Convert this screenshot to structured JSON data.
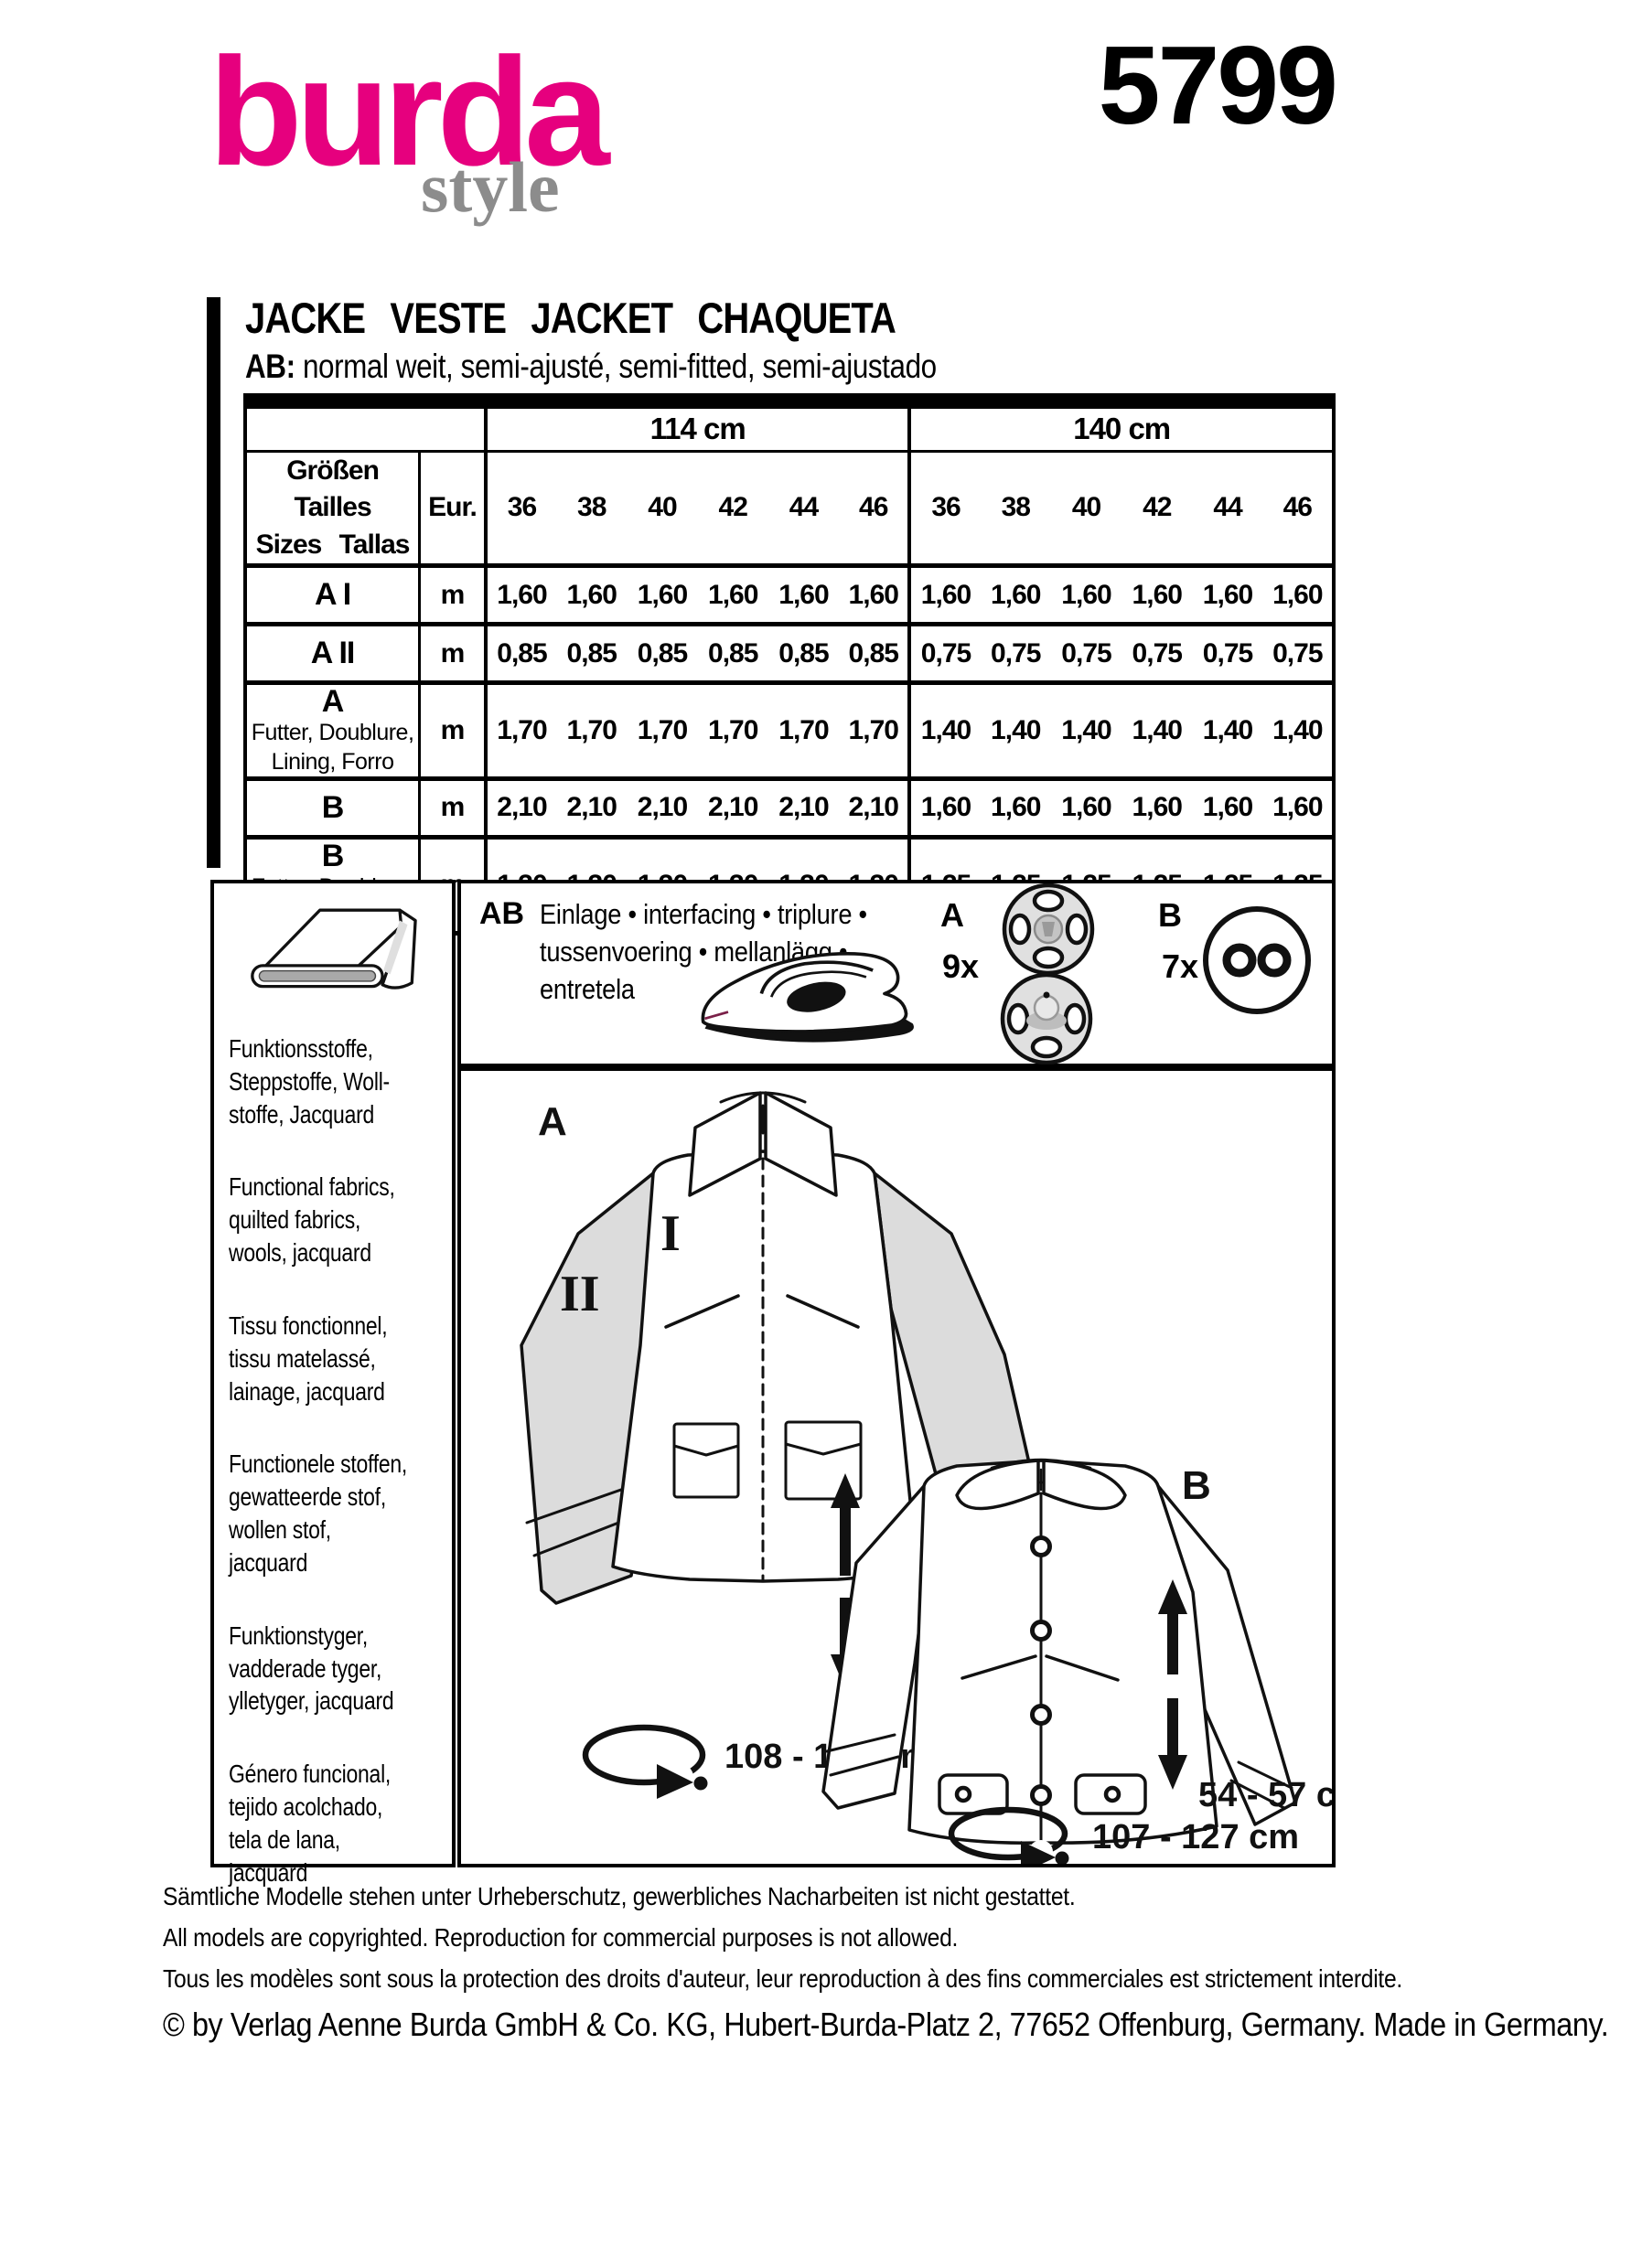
{
  "brand": {
    "name": "burda",
    "sub": "style",
    "pattern_number": "5799"
  },
  "colors": {
    "brand_pink": "#E6007E",
    "style_gray": "#8C8C8C",
    "sleeve_gray": "#DCDCDC"
  },
  "title": {
    "main": "JACKE VESTE JACKET CHAQUETA",
    "fit_bold": "AB:",
    "fit_rest": " normal weit, semi-ajusté, semi-fitted, semi-ajustado"
  },
  "table": {
    "width_groups": [
      "114 cm",
      "140 cm"
    ],
    "size_header": "Größen Tailles\nSizes Tallas",
    "eur_label": "Eur.",
    "sizes": [
      "36",
      "38",
      "40",
      "42",
      "44",
      "46"
    ],
    "rows": [
      {
        "label": "A I",
        "sub": "",
        "unit": "m",
        "v114": [
          "1,60",
          "1,60",
          "1,60",
          "1,60",
          "1,60",
          "1,60"
        ],
        "v140": [
          "1,60",
          "1,60",
          "1,60",
          "1,60",
          "1,60",
          "1,60"
        ]
      },
      {
        "label": "A II",
        "sub": "",
        "unit": "m",
        "v114": [
          "0,85",
          "0,85",
          "0,85",
          "0,85",
          "0,85",
          "0,85"
        ],
        "v140": [
          "0,75",
          "0,75",
          "0,75",
          "0,75",
          "0,75",
          "0,75"
        ]
      },
      {
        "label": "A",
        "sub": "Futter, Doublure,\nLining, Forro",
        "unit": "m",
        "v114": [
          "1,70",
          "1,70",
          "1,70",
          "1,70",
          "1,70",
          "1,70"
        ],
        "v140": [
          "1,40",
          "1,40",
          "1,40",
          "1,40",
          "1,40",
          "1,40"
        ]
      },
      {
        "label": "B",
        "sub": "",
        "unit": "m",
        "v114": [
          "2,10",
          "2,10",
          "2,10",
          "2,10",
          "2,10",
          "2,10"
        ],
        "v140": [
          "1,60",
          "1,60",
          "1,60",
          "1,60",
          "1,60",
          "1,60"
        ]
      },
      {
        "label": "B",
        "sub": "Futter, Doublure,\nLining, Forro",
        "unit": "m",
        "v114": [
          "1,30",
          "1,30",
          "1,30",
          "1,30",
          "1,30",
          "1,30"
        ],
        "v140": [
          "1,25",
          "1,25",
          "1,25",
          "1,25",
          "1,25",
          "1,25"
        ]
      }
    ]
  },
  "notions": {
    "group_label": "AB",
    "text": "Einlage • interfacing • triplure •\ntussenvoering • mellanlägg •\nentretela",
    "snap_label": "A",
    "snap_count": "9x",
    "button_label": "B",
    "button_count": "7x"
  },
  "fabrics": [
    "Funktionsstoffe,\nSteppstoffe, Woll-\nstoffe, Jacquard",
    "Functional fabrics,\nquilted fabrics,\nwools, jacquard",
    "Tissu fonctionnel,\ntissu matelassé,\nlainage, jacquard",
    "Functionele stoffen,\ngewatteerde stof,\nwollen stof, jacquard",
    "Funktionstyger,\nvadderade tyger,\nylletyger, jacquard",
    "Género funcional,\ntejido acolchado,\ntela de lana,\njacquard"
  ],
  "views": {
    "a": {
      "label": "A",
      "piece_body": "I",
      "piece_sleeve": "II",
      "length": "64 - 67 cm",
      "circumference": "108 - 128 cm"
    },
    "b": {
      "label": "B",
      "length": "54 - 57 cm",
      "circumference": "107 - 127 cm"
    }
  },
  "footer": {
    "line_de": "Sämtliche Modelle stehen unter Urheberschutz, gewerbliches Nacharbeiten ist nicht gestattet.",
    "line_en": "All models are copyrighted. Reproduction for commercial purposes is not allowed.",
    "line_fr": "Tous les modèles sont sous la protection des droits d'auteur, leur reproduction à des fins commerciales est strictement interdite.",
    "copyright": "© by Verlag Aenne Burda GmbH & Co. KG, Hubert-Burda-Platz 2, 77652 Offenburg, Germany. Made in Germany."
  }
}
